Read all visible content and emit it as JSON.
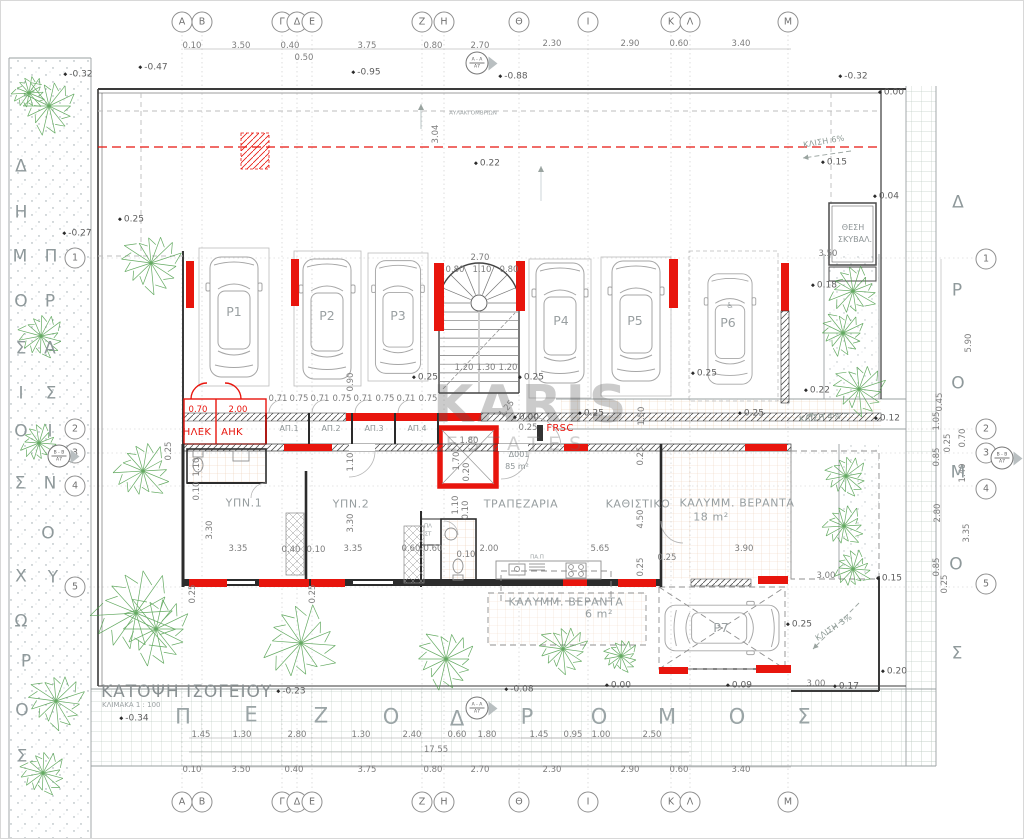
{
  "title": {
    "main": "ΚΑΤΟΨΗ ΙΣΟΓΕΙΟΥ",
    "scale": "ΚΛΙΜΑΚΑ 1 : 100"
  },
  "watermark": {
    "line1": "KARIS",
    "line2": "ESTATES"
  },
  "colors": {
    "red": "#e8150d",
    "green": "#4a9c47",
    "dim": "#7d7d7d",
    "wall": "#222222",
    "tile": "#ddab7e",
    "pave": "#c2cfc6"
  },
  "grid": {
    "cols": [
      [
        "Α",
        181
      ],
      [
        "Β",
        201
      ],
      [
        "Γ",
        281
      ],
      [
        "Δ",
        296
      ],
      [
        "Ε",
        311
      ],
      [
        "Ζ",
        421
      ],
      [
        "Η",
        443
      ],
      [
        "Θ",
        518
      ],
      [
        "Ι",
        587
      ],
      [
        "Κ",
        670
      ],
      [
        "Λ",
        689
      ],
      [
        "Μ",
        787
      ]
    ],
    "rows_left": [
      [
        "1",
        74,
        257
      ],
      [
        "2",
        74,
        428
      ],
      [
        "3",
        74,
        452
      ],
      [
        "4",
        74,
        485
      ],
      [
        "5",
        74,
        586
      ]
    ],
    "rows_right": [
      [
        "1",
        985,
        258
      ],
      [
        "2",
        985,
        428
      ],
      [
        "3",
        985,
        452
      ],
      [
        "4",
        985,
        488
      ],
      [
        "5",
        985,
        583
      ]
    ],
    "top_y": 21,
    "bottom_y": 801
  },
  "section_markers": [
    {
      "top": "Α - Α",
      "bottom": "Α7",
      "x": 476,
      "y": 62
    },
    {
      "top": "Α - Α",
      "bottom": "Α7",
      "x": 476,
      "y": 707
    },
    {
      "top": "Β - Β",
      "bottom": "Α7",
      "x": 58,
      "y": 455
    },
    {
      "top": "Β - Β",
      "bottom": "Α7",
      "x": 1001,
      "y": 457
    }
  ],
  "street_letters": [
    [
      "Π",
      182,
      716,
      "st"
    ],
    [
      "Ε",
      250,
      714,
      "st"
    ],
    [
      "Ζ",
      320,
      715,
      "st"
    ],
    [
      "Ο",
      390,
      716,
      "st"
    ],
    [
      "Δ",
      456,
      718,
      "st"
    ],
    [
      "Ρ",
      526,
      716,
      "st"
    ],
    [
      "Ο",
      598,
      716,
      "st"
    ],
    [
      "Μ",
      666,
      716,
      "st"
    ],
    [
      "Ο",
      736,
      716,
      "st"
    ],
    [
      "Σ",
      803,
      716,
      "st"
    ],
    [
      "Δ",
      957,
      202,
      "sv"
    ],
    [
      "Ρ",
      956,
      290,
      "sv"
    ],
    [
      "Ο",
      957,
      383,
      "sv"
    ],
    [
      "Μ",
      957,
      472,
      "sv"
    ],
    [
      "Ο",
      955,
      564,
      "sv"
    ],
    [
      "Σ",
      956,
      653,
      "sv"
    ],
    [
      "Δ",
      20,
      166,
      "sv"
    ],
    [
      "Η",
      20,
      212,
      "sv"
    ],
    [
      "Μ",
      19,
      256,
      "sv"
    ],
    [
      "Ο",
      20,
      301,
      "sv"
    ],
    [
      "Σ",
      20,
      348,
      "sv"
    ],
    [
      "Ι",
      20,
      393,
      "sv"
    ],
    [
      "Ο",
      20,
      431,
      "sv"
    ],
    [
      "Σ",
      19,
      483,
      "sv"
    ],
    [
      "Χ",
      20,
      576,
      "sv"
    ],
    [
      "Ω",
      20,
      621,
      "sv"
    ],
    [
      "Ρ",
      25,
      661,
      "sv"
    ],
    [
      "Ο",
      21,
      710,
      "sv"
    ],
    [
      "Σ",
      21,
      756,
      "sv"
    ],
    [
      "Π",
      50,
      256,
      "sv"
    ],
    [
      "Ρ",
      49,
      301,
      "sv"
    ],
    [
      "Α",
      49,
      348,
      "sv"
    ],
    [
      "Σ",
      50,
      393,
      "sv"
    ],
    [
      "Ι",
      49,
      431,
      "sv"
    ],
    [
      "Ν",
      49,
      483,
      "sv"
    ],
    [
      "Ο",
      47,
      533,
      "sv"
    ],
    [
      "Υ",
      52,
      577,
      "sv"
    ]
  ],
  "parking_labels": [
    [
      "P1",
      233,
      311
    ],
    [
      "P2",
      326,
      315
    ],
    [
      "P3",
      397,
      315
    ],
    [
      "P4",
      560,
      320
    ],
    [
      "P5",
      634,
      320
    ],
    [
      "P6",
      727,
      322
    ],
    [
      "P7",
      720,
      627
    ]
  ],
  "labels": [
    [
      "0.10",
      191,
      45,
      "d"
    ],
    [
      "3.50",
      240,
      45,
      "d"
    ],
    [
      "0.40",
      289,
      45,
      "d"
    ],
    [
      "0.50",
      303,
      57,
      "d"
    ],
    [
      "3.75",
      366,
      45,
      "d"
    ],
    [
      "0.80",
      432,
      45,
      "d"
    ],
    [
      "2.70",
      479,
      45,
      "d"
    ],
    [
      "2.30",
      551,
      43,
      "d"
    ],
    [
      "2.90",
      629,
      43,
      "d"
    ],
    [
      "0.60",
      678,
      43,
      "d"
    ],
    [
      "3.40",
      740,
      43,
      "d"
    ],
    [
      "0.10",
      191,
      769,
      "d"
    ],
    [
      "3.50",
      240,
      769,
      "d"
    ],
    [
      "0.40",
      293,
      769,
      "d"
    ],
    [
      "3.75",
      366,
      769,
      "d"
    ],
    [
      "0.80",
      432,
      769,
      "d"
    ],
    [
      "2.70",
      479,
      769,
      "d"
    ],
    [
      "2.30",
      551,
      769,
      "d"
    ],
    [
      "2.90",
      629,
      769,
      "d"
    ],
    [
      "0.60",
      678,
      769,
      "d"
    ],
    [
      "3.40",
      740,
      769,
      "d"
    ],
    [
      "1.45",
      200,
      734,
      "d"
    ],
    [
      "1.30",
      241,
      734,
      "d"
    ],
    [
      "2.80",
      296,
      734,
      "d"
    ],
    [
      "1.30",
      360,
      734,
      "d"
    ],
    [
      "2.40",
      411,
      734,
      "d"
    ],
    [
      "0.60",
      456,
      734,
      "d"
    ],
    [
      "1.80",
      486,
      734,
      "d"
    ],
    [
      "17.55",
      435,
      749,
      "d"
    ],
    [
      "1.45",
      538,
      734,
      "d"
    ],
    [
      "0.95",
      572,
      734,
      "d"
    ],
    [
      "1.00",
      600,
      734,
      "d"
    ],
    [
      "2.50",
      651,
      734,
      "d"
    ],
    [
      "2.70",
      479,
      257,
      "d"
    ],
    [
      "0.80",
      454,
      269,
      "d"
    ],
    [
      "1.10",
      481,
      269,
      "d"
    ],
    [
      "0.80",
      508,
      269,
      "d"
    ],
    [
      "1.20",
      463,
      367,
      "d"
    ],
    [
      "1.30",
      485,
      367,
      "d"
    ],
    [
      "1.20",
      507,
      367,
      "d"
    ],
    [
      "0.71",
      277,
      398,
      "d"
    ],
    [
      "0.75",
      298,
      398,
      "d"
    ],
    [
      "0.71",
      319,
      398,
      "d"
    ],
    [
      "0.75",
      341,
      398,
      "d"
    ],
    [
      "0.71",
      362,
      398,
      "d"
    ],
    [
      "0.75",
      384,
      398,
      "d"
    ],
    [
      "0.71",
      405,
      398,
      "d"
    ],
    [
      "0.75",
      427,
      398,
      "d"
    ],
    [
      "1.80",
      468,
      440,
      "d"
    ],
    [
      "0.25",
      527,
      427,
      "d"
    ],
    [
      "3.35",
      237,
      548,
      "d"
    ],
    [
      "0.40",
      290,
      549,
      "d"
    ],
    [
      "0.10",
      315,
      549,
      "d"
    ],
    [
      "3.35",
      352,
      548,
      "d"
    ],
    [
      "0.60",
      410,
      548,
      "d"
    ],
    [
      "0.60",
      432,
      548,
      "d"
    ],
    [
      "2.00",
      488,
      548,
      "d"
    ],
    [
      "0.10",
      465,
      554,
      "d"
    ],
    [
      "5.65",
      599,
      548,
      "d"
    ],
    [
      "3.90",
      743,
      548,
      "d"
    ],
    [
      "0.25",
      666,
      557,
      "d"
    ],
    [
      "3.50",
      827,
      253,
      "d"
    ],
    [
      "3.00",
      825,
      575,
      "d"
    ],
    [
      "3.00",
      815,
      683,
      "d"
    ],
    [
      "1.25",
      506,
      408,
      "d",
      -50
    ],
    [
      "3.04",
      435,
      133,
      "dv",
      -90
    ],
    [
      "0.90",
      350,
      381,
      "dv",
      -90
    ],
    [
      "1.50",
      641,
      415,
      "dv",
      -90
    ],
    [
      "1.70",
      456,
      460,
      "dv",
      -90
    ],
    [
      "0.20",
      466,
      471,
      "dv",
      -90
    ],
    [
      "1.10",
      196,
      466,
      "dv",
      -90
    ],
    [
      "0.10",
      196,
      490,
      "dv",
      -90
    ],
    [
      "3.30",
      209,
      529,
      "dv",
      -90
    ],
    [
      "1.10",
      350,
      461,
      "dv",
      -90
    ],
    [
      "3.30",
      350,
      522,
      "dv",
      -90
    ],
    [
      "1.10",
      455,
      504,
      "dv",
      -90
    ],
    [
      "0.10",
      465,
      509,
      "dv",
      -90
    ],
    [
      "4.50",
      640,
      518,
      "dv",
      -90
    ],
    [
      "0.25",
      640,
      455,
      "dv",
      -90
    ],
    [
      "0.25",
      640,
      566,
      "dv",
      -90
    ],
    [
      "0.25",
      168,
      450,
      "dv",
      -90
    ],
    [
      "0.25",
      192,
      593,
      "dv",
      -90
    ],
    [
      "0.25",
      312,
      593,
      "dv",
      -90
    ],
    [
      "5.90",
      968,
      342,
      "dv",
      -90
    ],
    [
      "0.45",
      939,
      401,
      "dv",
      -90
    ],
    [
      "1.05",
      936,
      420,
      "dv",
      -90
    ],
    [
      "0.70",
      962,
      437,
      "dv",
      -90
    ],
    [
      "0.25",
      947,
      442,
      "dv",
      -90
    ],
    [
      "0.85",
      936,
      456,
      "dv",
      -90
    ],
    [
      "1.40",
      962,
      472,
      "dv",
      -90
    ],
    [
      "2.80",
      937,
      512,
      "dv",
      -90
    ],
    [
      "3.35",
      966,
      532,
      "dv",
      -90
    ],
    [
      "0.85",
      936,
      566,
      "dv",
      -90
    ],
    [
      "0.25",
      944,
      583,
      "dv",
      -90
    ],
    [
      "0.70",
      197,
      409,
      "dr"
    ],
    [
      "2.00",
      237,
      409,
      "dr"
    ],
    [
      "ΗΛΕΚ",
      196,
      432,
      "rr"
    ],
    [
      "ΑΗΚ",
      231,
      432,
      "rr"
    ],
    [
      "FRSC",
      559,
      428,
      "rr"
    ],
    [
      "ΥΠΝ.1",
      243,
      502,
      "rm"
    ],
    [
      "ΥΠΝ.2",
      350,
      503,
      "rm"
    ],
    [
      "ΤΡΑΠΕΖΑΡΙΑ",
      520,
      503,
      "rm"
    ],
    [
      "ΚΑΘΙΣΤΙΚΟ",
      637,
      503,
      "rm"
    ],
    [
      "ΚΑΛΥΜΜ. ΒΕΡΑΝΤΑ",
      736,
      502,
      "rm"
    ],
    [
      "18 m²",
      710,
      516,
      "rm"
    ],
    [
      "ΚΑΛΥΜΜ. ΒΕΡΑΝΤΑ",
      565,
      601,
      "rm"
    ],
    [
      "6 m²",
      598,
      613,
      "rm"
    ],
    [
      "Δ001",
      518,
      454,
      "rs"
    ],
    [
      "85 m²",
      516,
      466,
      "rs"
    ],
    [
      "ΑΠ.1",
      288,
      428,
      "rs"
    ],
    [
      "ΑΠ.2",
      330,
      428,
      "rs"
    ],
    [
      "ΑΠ.3",
      373,
      428,
      "rs"
    ],
    [
      "ΑΠ.4",
      416,
      428,
      "rs"
    ],
    [
      "ΘΕΣΗ",
      852,
      227,
      "rs"
    ],
    [
      "ΣΚΥΒΑΛ.",
      854,
      239,
      "rs"
    ],
    [
      "♿",
      729,
      305,
      "rs",
      0,
      "wheelchair-icon"
    ],
    [
      "ΑΥΛΑΚΙ ΟΜΒΡΙΩΝ",
      472,
      113,
      "ty"
    ],
    [
      "ΠΛ",
      427,
      526,
      "ty"
    ],
    [
      "ΣΤ",
      427,
      534,
      "ty"
    ],
    [
      "ΠΑ.Π",
      536,
      557,
      "ty"
    ],
    [
      "ΚΛΙΣΗ 6%",
      823,
      141,
      "sl",
      -10
    ],
    [
      "ΚΛΙΣΗ 4%",
      819,
      417,
      "sl",
      -4
    ],
    [
      "ΚΛΙΣΗ 3%",
      833,
      627,
      "sl",
      -33
    ]
  ],
  "levels": [
    [
      "-0.32",
      77,
      74
    ],
    [
      "-0.47",
      152,
      67
    ],
    [
      "-0.95",
      365,
      72
    ],
    [
      "-0.88",
      512,
      76
    ],
    [
      "-0.32",
      852,
      76
    ],
    [
      "0.00",
      890,
      92
    ],
    [
      "-0.27",
      76,
      233
    ],
    [
      "0.25",
      130,
      219
    ],
    [
      "0.22",
      486,
      163
    ],
    [
      "0.15",
      833,
      162
    ],
    [
      "0.04",
      885,
      196
    ],
    [
      "0.18",
      823,
      285
    ],
    [
      "0.22",
      816,
      390
    ],
    [
      "0.12",
      886,
      418
    ],
    [
      "0.00",
      525,
      417
    ],
    [
      "0.25",
      424,
      377
    ],
    [
      "0.25",
      530,
      377
    ],
    [
      "0.25",
      703,
      373
    ],
    [
      "0.25",
      590,
      413
    ],
    [
      "0.25",
      750,
      413
    ],
    [
      "0.25",
      798,
      624
    ],
    [
      "0.15",
      888,
      578
    ],
    [
      "0.20",
      893,
      671
    ],
    [
      "0.17",
      845,
      686
    ],
    [
      "0.09",
      738,
      685
    ],
    [
      "0.00",
      617,
      685
    ],
    [
      "-0.08",
      518,
      689
    ],
    [
      "-0.34",
      133,
      718
    ],
    [
      "-0.23",
      290,
      691
    ]
  ]
}
